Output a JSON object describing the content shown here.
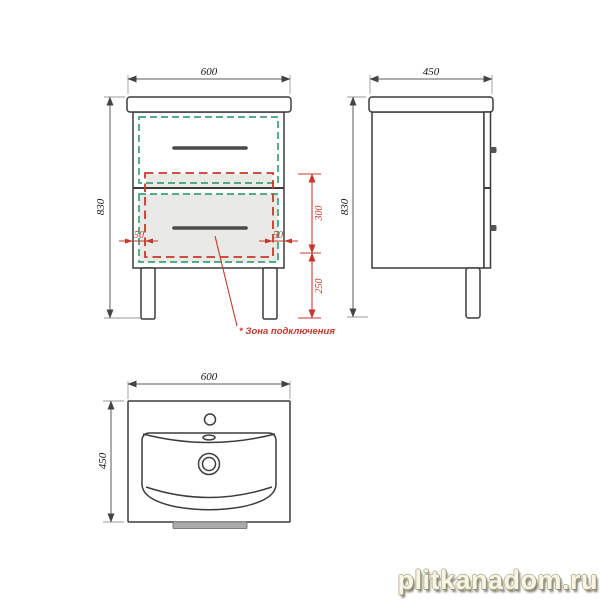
{
  "drawing": {
    "front_view": {
      "width_mm": "600",
      "height_mm": "830",
      "zone_height_mm": "300",
      "zone_floor_offset_mm": "250",
      "zone_side_offset_left_mm": "50",
      "zone_side_offset_right_mm": "50",
      "connection_zone_note": "* Зона подключения"
    },
    "side_view": {
      "depth_mm": "450",
      "height_mm": "830"
    },
    "basin_top_view": {
      "width_mm": "600",
      "depth_mm": "450"
    }
  },
  "colors": {
    "drawing_line": "#3c3c3c",
    "connection_zone_red": "#c6382d",
    "drawer_inner_zone_green": "#3da077",
    "highlight_fill_gray": "#e9e9e6",
    "watermark_cream": "#f8f5e0"
  },
  "watermark": {
    "text": "plitkanadom.ru"
  }
}
